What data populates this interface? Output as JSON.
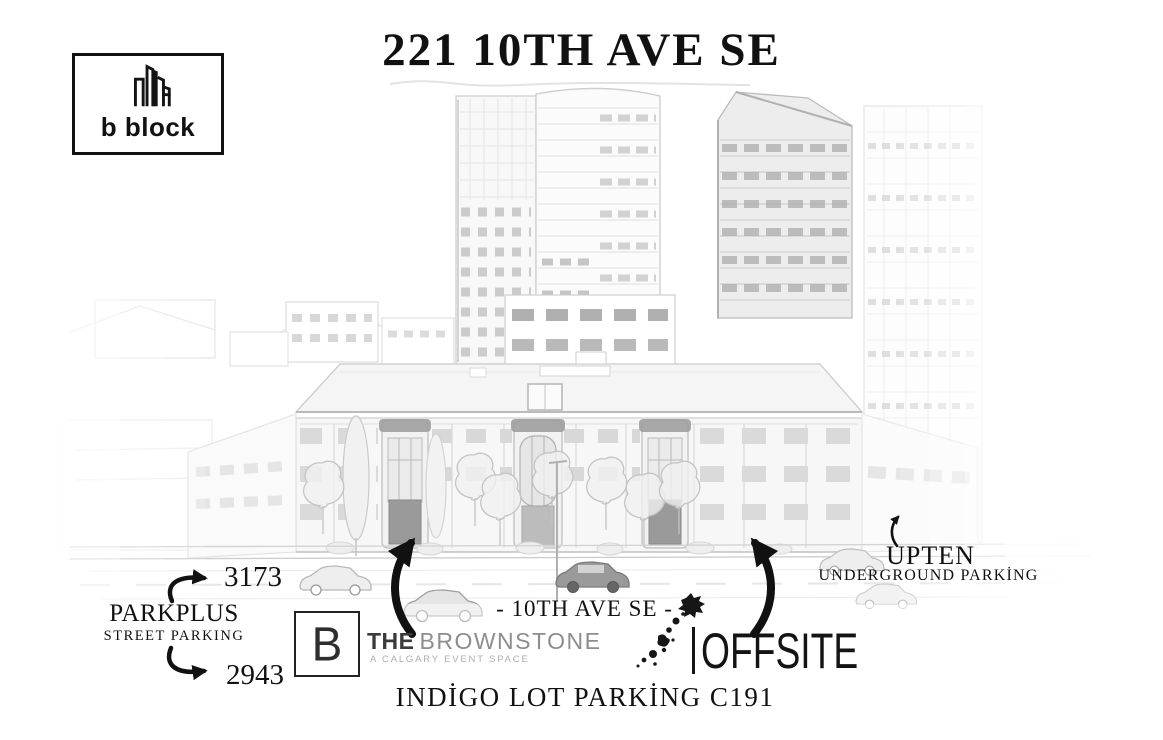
{
  "colors": {
    "ink": "#111111",
    "paper": "#ffffff",
    "sketch_light": "#c8c8c8",
    "sketch_dark": "#9a9a9a",
    "brand_gray": "#8d8d8d",
    "tagline_gray": "#adadad"
  },
  "header": {
    "logo_label": "b block",
    "title": "221 10TH AVE SE"
  },
  "street": {
    "label": "- 10TH AVE SE -"
  },
  "parking": {
    "parkplus_title": "PARKPLUS",
    "parkplus_subtitle": "STREET PARKING",
    "parkplus_zone_upper": "3173",
    "parkplus_zone_lower": "2943",
    "upten_title": "UPTEN",
    "upten_subtitle": "UNDERGROUND PARKİNG",
    "indigo_label": "INDİGO LOT PARKİNG C191"
  },
  "brands": {
    "brownstone_initial": "B",
    "brownstone_prefix": "THE",
    "brownstone_name": "BROWNSTONE",
    "brownstone_tagline": "A CALGARY EVENT SPACE",
    "offsite_name": "OFFSITE"
  },
  "icons": {
    "bblock_building_icon": "twin-highrise-outline",
    "entrance_arrow_icon": "curved-black-arrow",
    "offsite_splatter_icon": "ink-splatter-runner"
  }
}
